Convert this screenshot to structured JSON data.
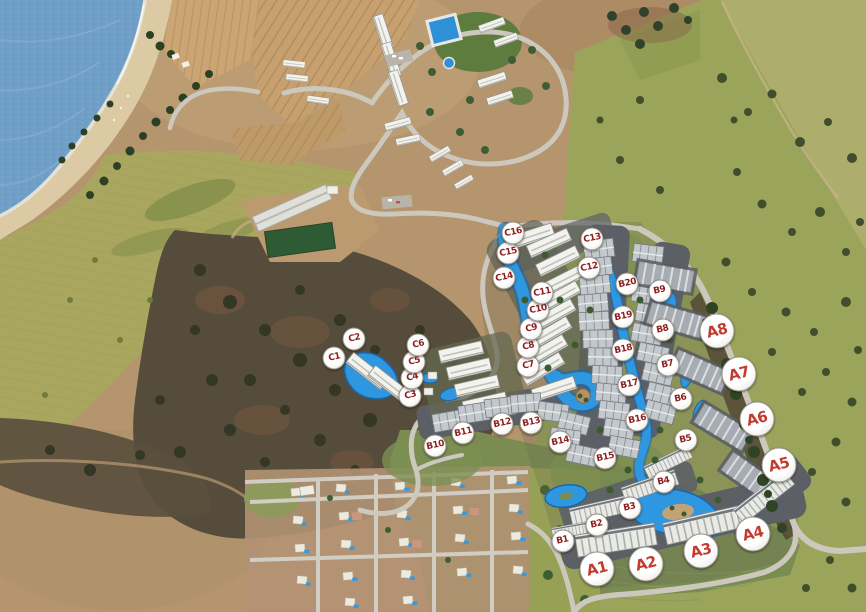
{
  "map": {
    "kind": "resort-master-plan-aerial",
    "markers": {
      "badge_bg": "#ffffff",
      "badge_border": "#97938a",
      "series": [
        {
          "name": "A",
          "style": "large",
          "text_color": "#c23b2e",
          "items": [
            {
              "label": "A1",
              "x": 597,
              "y": 569
            },
            {
              "label": "A2",
              "x": 646,
              "y": 564
            },
            {
              "label": "A3",
              "x": 701,
              "y": 551
            },
            {
              "label": "A4",
              "x": 753,
              "y": 534
            },
            {
              "label": "A5",
              "x": 779,
              "y": 465
            },
            {
              "label": "A6",
              "x": 757,
              "y": 419
            },
            {
              "label": "A7",
              "x": 739,
              "y": 374
            },
            {
              "label": "A8",
              "x": 717,
              "y": 331
            }
          ]
        },
        {
          "name": "B",
          "style": "small",
          "text_color": "#8f1f1f",
          "items": [
            {
              "label": "B1",
              "x": 563,
              "y": 541
            },
            {
              "label": "B2",
              "x": 597,
              "y": 525
            },
            {
              "label": "B3",
              "x": 630,
              "y": 508
            },
            {
              "label": "B4",
              "x": 664,
              "y": 482
            },
            {
              "label": "B5",
              "x": 686,
              "y": 440
            },
            {
              "label": "B6",
              "x": 681,
              "y": 399
            },
            {
              "label": "B7",
              "x": 668,
              "y": 365
            },
            {
              "label": "B8",
              "x": 663,
              "y": 330
            },
            {
              "label": "B9",
              "x": 660,
              "y": 291
            },
            {
              "label": "B10",
              "x": 435,
              "y": 446
            },
            {
              "label": "B11",
              "x": 463,
              "y": 433
            },
            {
              "label": "B12",
              "x": 502,
              "y": 424
            },
            {
              "label": "B13",
              "x": 531,
              "y": 423
            },
            {
              "label": "B14",
              "x": 560,
              "y": 442
            },
            {
              "label": "B15",
              "x": 605,
              "y": 458
            },
            {
              "label": "B16",
              "x": 637,
              "y": 420
            },
            {
              "label": "B17",
              "x": 629,
              "y": 385
            },
            {
              "label": "B18",
              "x": 623,
              "y": 350
            },
            {
              "label": "B19",
              "x": 623,
              "y": 317
            },
            {
              "label": "B20",
              "x": 627,
              "y": 284
            }
          ]
        },
        {
          "name": "C",
          "style": "small",
          "text_color": "#8f1f1f",
          "items": [
            {
              "label": "C1",
              "x": 334,
              "y": 358
            },
            {
              "label": "C2",
              "x": 354,
              "y": 339
            },
            {
              "label": "C3",
              "x": 410,
              "y": 396
            },
            {
              "label": "C4",
              "x": 412,
              "y": 378
            },
            {
              "label": "C5",
              "x": 414,
              "y": 362
            },
            {
              "label": "C6",
              "x": 418,
              "y": 345
            },
            {
              "label": "C7",
              "x": 528,
              "y": 366
            },
            {
              "label": "C8",
              "x": 528,
              "y": 347
            },
            {
              "label": "C9",
              "x": 531,
              "y": 329
            },
            {
              "label": "C10",
              "x": 538,
              "y": 310
            },
            {
              "label": "C11",
              "x": 542,
              "y": 293
            },
            {
              "label": "C12",
              "x": 589,
              "y": 268
            },
            {
              "label": "C13",
              "x": 592,
              "y": 239
            },
            {
              "label": "C14",
              "x": 504,
              "y": 278
            },
            {
              "label": "C15",
              "x": 508,
              "y": 253
            },
            {
              "label": "C16",
              "x": 513,
              "y": 233
            }
          ]
        }
      ]
    },
    "terrain_colors": {
      "sea": "#6f9ec6",
      "beach": "#dccaa4",
      "olive_field": "#a9a65f",
      "right_field": "#9aa45a",
      "scrub": "#564c3b",
      "road": "#cdc8be",
      "lagoon": "#2f96e0",
      "grass": "#7a8c52",
      "roofs": "#f2f2ee"
    }
  }
}
